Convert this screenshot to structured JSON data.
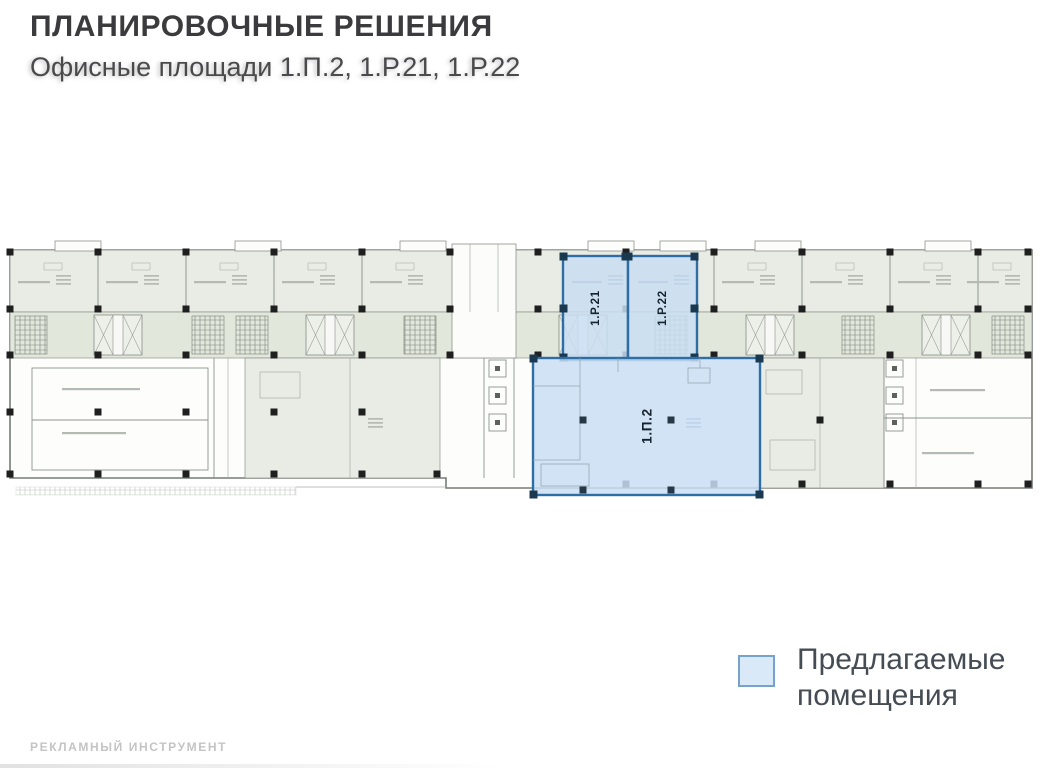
{
  "header": {
    "title": "ПЛАНИРОВОЧНЫЕ РЕШЕНИЯ",
    "subtitle": "Офисные площади 1.П.2, 1.Р.21, 1.Р.22"
  },
  "plan": {
    "highlighted_rooms": [
      {
        "label": "1.Р.21"
      },
      {
        "label": "1.Р.22"
      },
      {
        "label": "1.П.2"
      }
    ],
    "colors": {
      "room_fill": "#e9ece5",
      "corridor_fill": "#e2e7dc",
      "wall": "#8d938c",
      "column": "#1f1f1f",
      "highlight_fill": "#c9def2",
      "highlight_border": "#2f6ea5"
    }
  },
  "legend": {
    "label": "Предлагаемые помещения",
    "swatch_color": "#d9e9f7",
    "swatch_border": "#76a3cc"
  },
  "footer": {
    "label": "РЕКЛАМНЫЙ ИНСТРУМЕНТ"
  }
}
